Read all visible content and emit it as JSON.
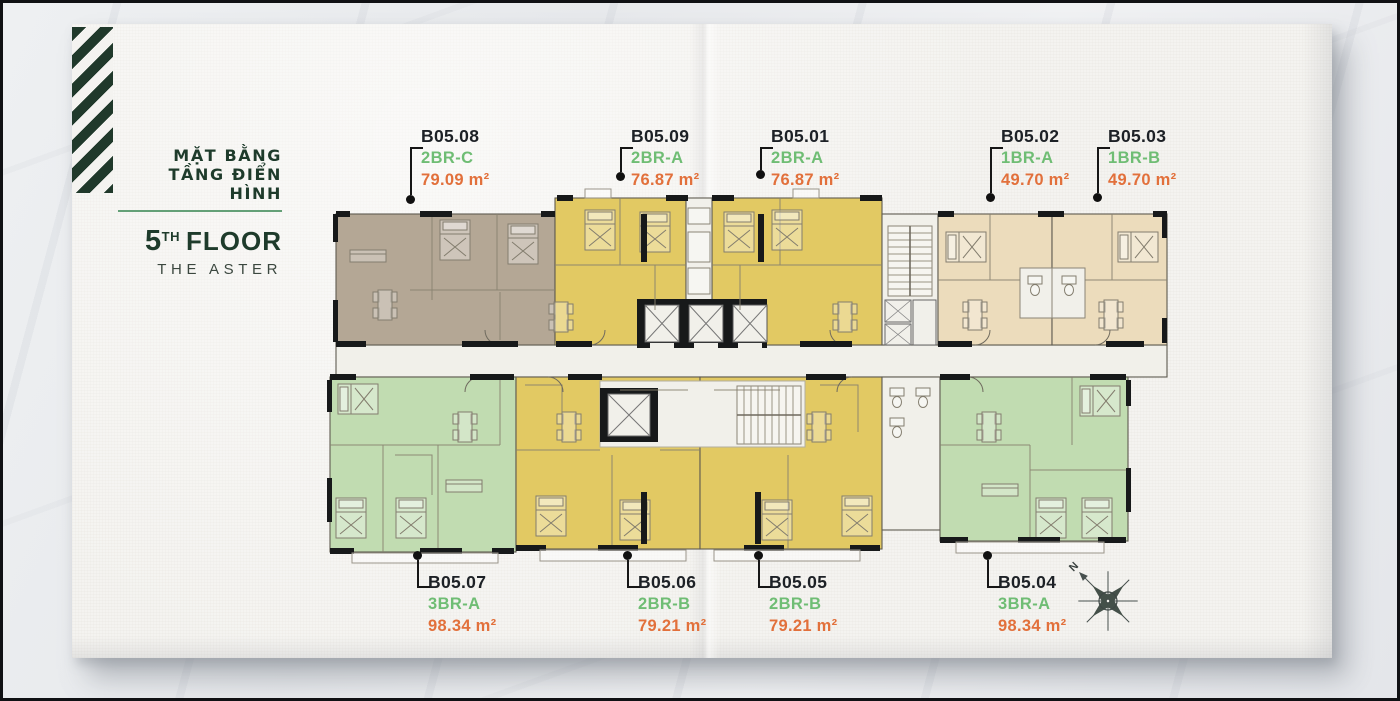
{
  "header": {
    "title_line1": "MẶT BẰNG",
    "title_line2": "TẦNG ĐIỂN HÌNH",
    "floor_number": "5",
    "floor_ordinal": "TH",
    "floor_label": "FLOOR",
    "subtitle": "THE ASTER"
  },
  "colors": {
    "brand_green": "#1e3b2b",
    "accent_underline": "#64a077",
    "type_green": "#6fbd74",
    "area_orange": "#e2703b",
    "unit_yellow": "#e2c963",
    "unit_taupe": "#b4a795",
    "unit_cream": "#ecdcbc",
    "unit_green": "#c1dcb1",
    "core_white": "#f1f0ea",
    "wall_black": "#17191a"
  },
  "units": [
    {
      "id": "B05.08",
      "type": "2BR-C",
      "area": "79.09 m²",
      "color": "taupe",
      "position": "top"
    },
    {
      "id": "B05.09",
      "type": "2BR-A",
      "area": "76.87 m²",
      "color": "yellow",
      "position": "top"
    },
    {
      "id": "B05.01",
      "type": "2BR-A",
      "area": "76.87 m²",
      "color": "yellow",
      "position": "top"
    },
    {
      "id": "B05.02",
      "type": "1BR-A",
      "area": "49.70 m²",
      "color": "cream",
      "position": "top"
    },
    {
      "id": "B05.03",
      "type": "1BR-B",
      "area": "49.70 m²",
      "color": "cream",
      "position": "top"
    },
    {
      "id": "B05.07",
      "type": "3BR-A",
      "area": "98.34 m²",
      "color": "green",
      "position": "bottom"
    },
    {
      "id": "B05.06",
      "type": "2BR-B",
      "area": "79.21 m²",
      "color": "yellow",
      "position": "bottom"
    },
    {
      "id": "B05.05",
      "type": "2BR-B",
      "area": "79.21 m²",
      "color": "yellow",
      "position": "bottom"
    },
    {
      "id": "B05.04",
      "type": "3BR-A",
      "area": "98.34 m²",
      "color": "green",
      "position": "bottom"
    }
  ],
  "compass": {
    "north_label": "N"
  }
}
